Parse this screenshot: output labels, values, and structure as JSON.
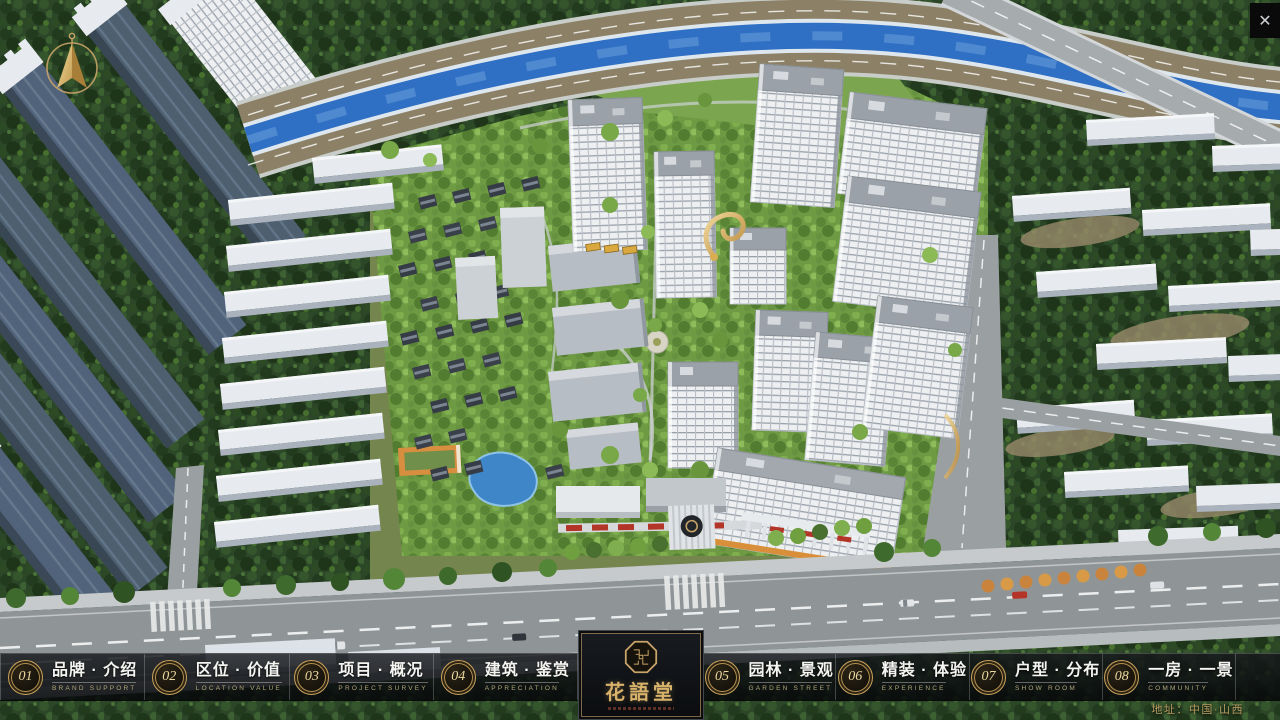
{
  "window": {
    "close_glyph": "✕"
  },
  "brand": {
    "name": "花語堂"
  },
  "nav": {
    "items": [
      {
        "num": "01",
        "label": "品牌 · 介绍",
        "sub": "BRAND SUPPORT"
      },
      {
        "num": "02",
        "label": "区位 · 价值",
        "sub": "LOCATION VALUE"
      },
      {
        "num": "03",
        "label": "项目 · 概况",
        "sub": "PROJECT SURVEY"
      },
      {
        "num": "04",
        "label": "建筑 · 鉴赏",
        "sub": "APPRECIATION"
      },
      {
        "num": "05",
        "label": "园林 · 景观",
        "sub": "GARDEN STREET"
      },
      {
        "num": "06",
        "label": "精装 · 体验",
        "sub": "EXPERIENCE"
      },
      {
        "num": "07",
        "label": "户型 · 分布",
        "sub": "SHOW ROOM"
      },
      {
        "num": "08",
        "label": "一房 · 一景",
        "sub": "COMMUNITY"
      }
    ]
  },
  "footer": {
    "address": "地址：中国·山西"
  },
  "colors": {
    "gold": "#c9a469",
    "river": "#2f6fc4",
    "nav_bg": "rgba(10,12,15,0.82)",
    "sign_red": "#b23527"
  }
}
